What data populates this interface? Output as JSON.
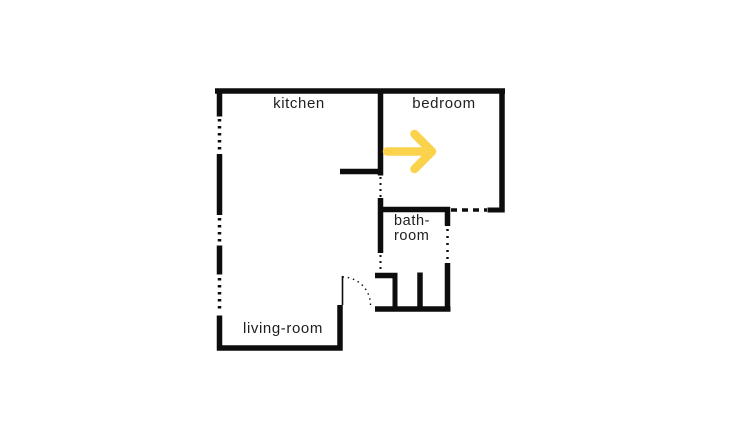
{
  "colors": {
    "wall": "#0d0d0d",
    "arrow": "#fbd24c",
    "background": "#ffffff",
    "label_text": "#1f1f1f"
  },
  "rooms": {
    "kitchen": {
      "label": "kitchen"
    },
    "bedroom": {
      "label": "bedroom"
    },
    "bathroom": {
      "label_line1": "bath-",
      "label_line2": "room"
    },
    "living_room": {
      "label": "living-room"
    }
  },
  "arrow": {
    "direction": "right",
    "room": "bedroom"
  }
}
